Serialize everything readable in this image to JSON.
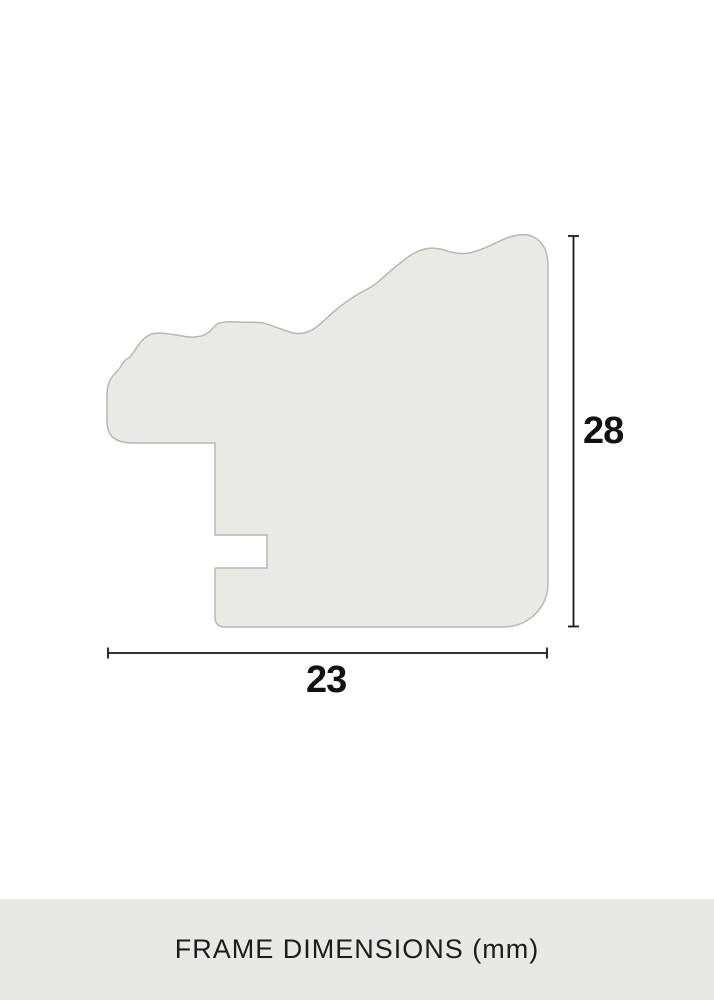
{
  "diagram": {
    "type": "picture-frame-moulding-cross-section",
    "caption": "FRAME DIMENSIONS (mm)",
    "unit": "mm",
    "width_mm": 23,
    "height_mm": 28,
    "width_label": "23",
    "height_label": "28"
  },
  "colors": {
    "background": "#ffffff",
    "profile_fill": "#e9e9e5",
    "profile_stroke": "#b7b7b4",
    "dimension_line": "#1a1a1a",
    "caption_bar_bg": "#e8e8e4",
    "caption_text": "#1c1c1a",
    "label_text": "#111111"
  }
}
